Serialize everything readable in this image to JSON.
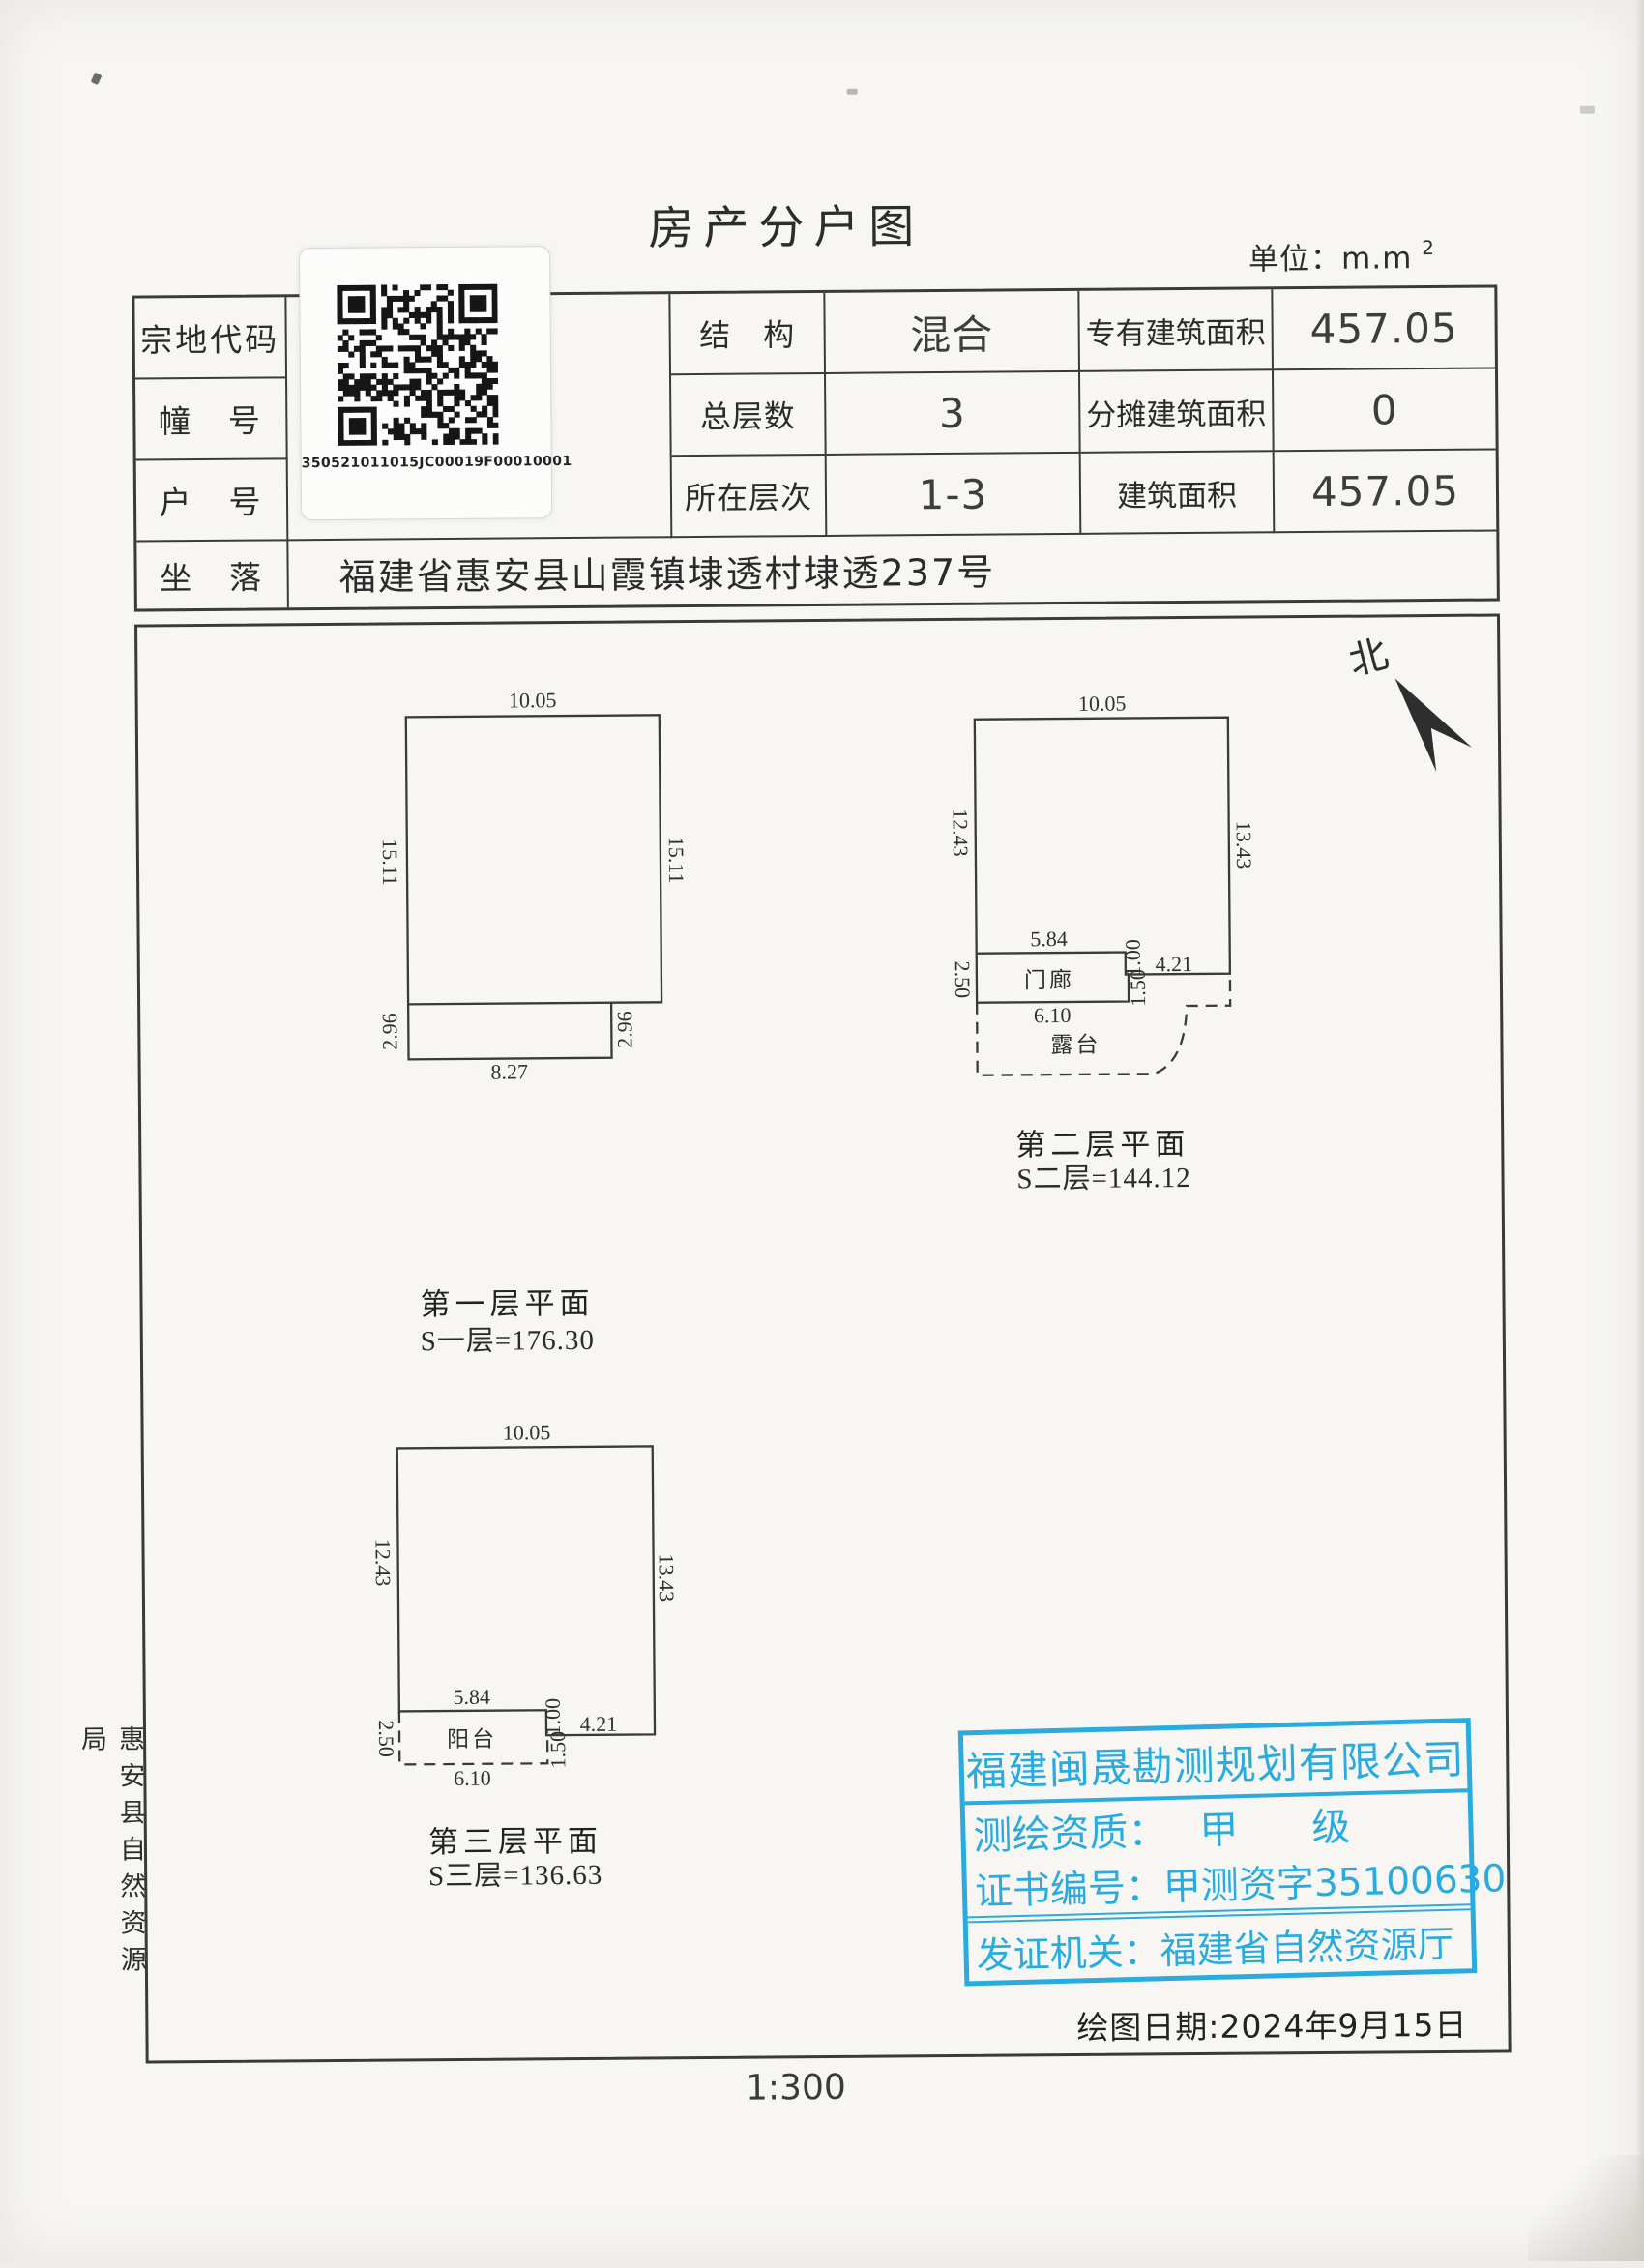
{
  "page": {
    "title": "房产分户图",
    "unit_prefix": "单位：m.m",
    "unit_sup": "2",
    "north": "北",
    "scale": "1:300",
    "draw_date": "绘图日期:2024年9月15日",
    "agency_side": "惠安县自然资源局"
  },
  "qr": {
    "code": "350521011015JC00019F00010001"
  },
  "info_table": {
    "rows": [
      {
        "label": "宗地代码",
        "name": "结　构",
        "value": "混合",
        "area_label": "专有建筑面积",
        "area_value": "457.05"
      },
      {
        "label": "幢　号",
        "name": "总层数",
        "value": "3",
        "area_label": "分摊建筑面积",
        "area_value": "0"
      },
      {
        "label": "户　号",
        "name": "所在层次",
        "value": "1-3",
        "area_label": "建筑面积",
        "area_value": "457.05"
      }
    ],
    "location_label": "坐　落",
    "location_value": "福建省惠安县山霞镇埭透村埭透237号"
  },
  "plans": [
    {
      "caption": "第一层平面",
      "area": "S一层=176.30",
      "dims": {
        "top": "10.05",
        "left": "15.11",
        "right": "15.11",
        "ext_left": "2.96",
        "ext_right": "2.96",
        "bottom": "8.27"
      }
    },
    {
      "caption": "第二层平面",
      "area": "S二层=144.12",
      "dims": {
        "top": "10.05",
        "left": "12.43",
        "right": "13.43",
        "mid": "5.84",
        "porch_left": "2.50",
        "step": "1.00",
        "porch_right": "1.50",
        "right_bottom": "4.21",
        "porch_bottom": "6.10"
      },
      "rooms": {
        "porch": "门廊",
        "terrace": "露台"
      }
    },
    {
      "caption": "第三层平面",
      "area": "S三层=136.63",
      "dims": {
        "top": "10.05",
        "left": "12.43",
        "right": "13.43",
        "mid": "5.84",
        "balcony_left": "2.50",
        "step": "1.00",
        "balcony_right": "1.50",
        "right_bottom": "4.21",
        "balcony_bottom": "6.10"
      },
      "rooms": {
        "balcony": "阳台"
      }
    }
  ],
  "stamp": {
    "company": "福建闽晟勘测规划有限公司",
    "qual_label": "测绘资质：",
    "qual_value": "甲　级",
    "cert_line": "证书编号：甲测资字35100630",
    "issuer_line": "发证机关：福建省自然资源厅",
    "color": "#2aabdf"
  }
}
